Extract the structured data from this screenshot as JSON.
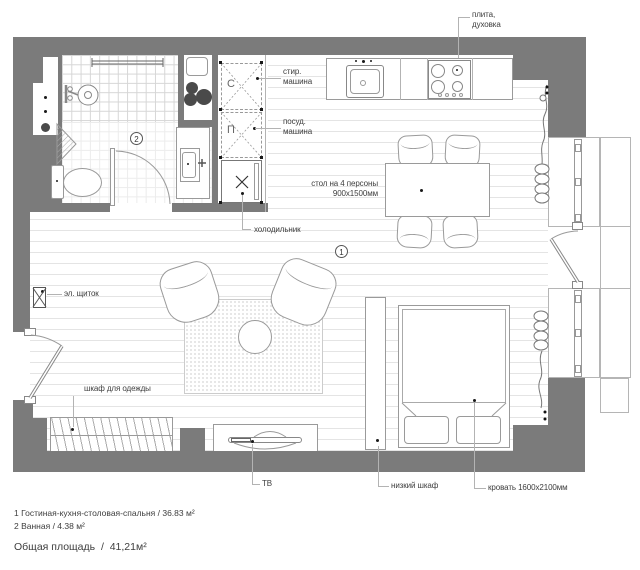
{
  "plan": {
    "unit_labels": {
      "stove_l1": "плита,",
      "stove_l2": "духовка",
      "washer_l1": "стир.",
      "washer_l2": "машина",
      "dishwasher_l1": "посуд.",
      "dishwasher_l2": "машина",
      "table_l1": "стол на 4 персоны",
      "table_l2": "900х1500мм",
      "fridge": "холодильник",
      "electrical_panel": "эл. щиток",
      "wardrobe": "шкаф для одежды",
      "tv": "ТВ",
      "low_cabinet": "низкий шкаф",
      "bed": "кровать 1600х2100мм"
    },
    "room_markers": {
      "living": "1",
      "bathroom": "2"
    },
    "appliance_letters": {
      "washer": "С",
      "dishwasher": "П"
    },
    "legend": {
      "room1": "1 Гостиная-кухня-столовая-спальня / 36.83 м²",
      "room2": "2 Ванная / 4.38 м²",
      "total": "Общая площадь  /  41,21м²"
    },
    "colors": {
      "wall": "#7b7b7b",
      "outline": "#9a9a9a",
      "text": "#3d3d3d",
      "floor_line": "#e4e4e4"
    }
  }
}
